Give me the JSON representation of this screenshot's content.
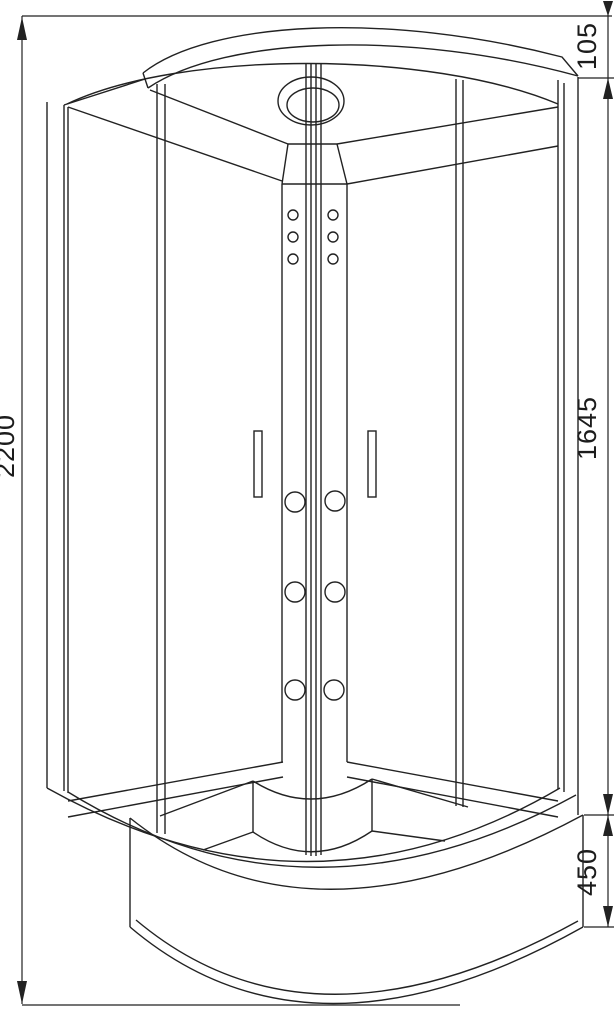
{
  "drawing": {
    "kind": "shower-cabin-front-elevation",
    "line_color": "#222222",
    "background_color": "#ffffff",
    "dimensions": {
      "overall_height": "2200",
      "roof_height": "105",
      "body_height": "1645",
      "tray_height": "450"
    }
  }
}
